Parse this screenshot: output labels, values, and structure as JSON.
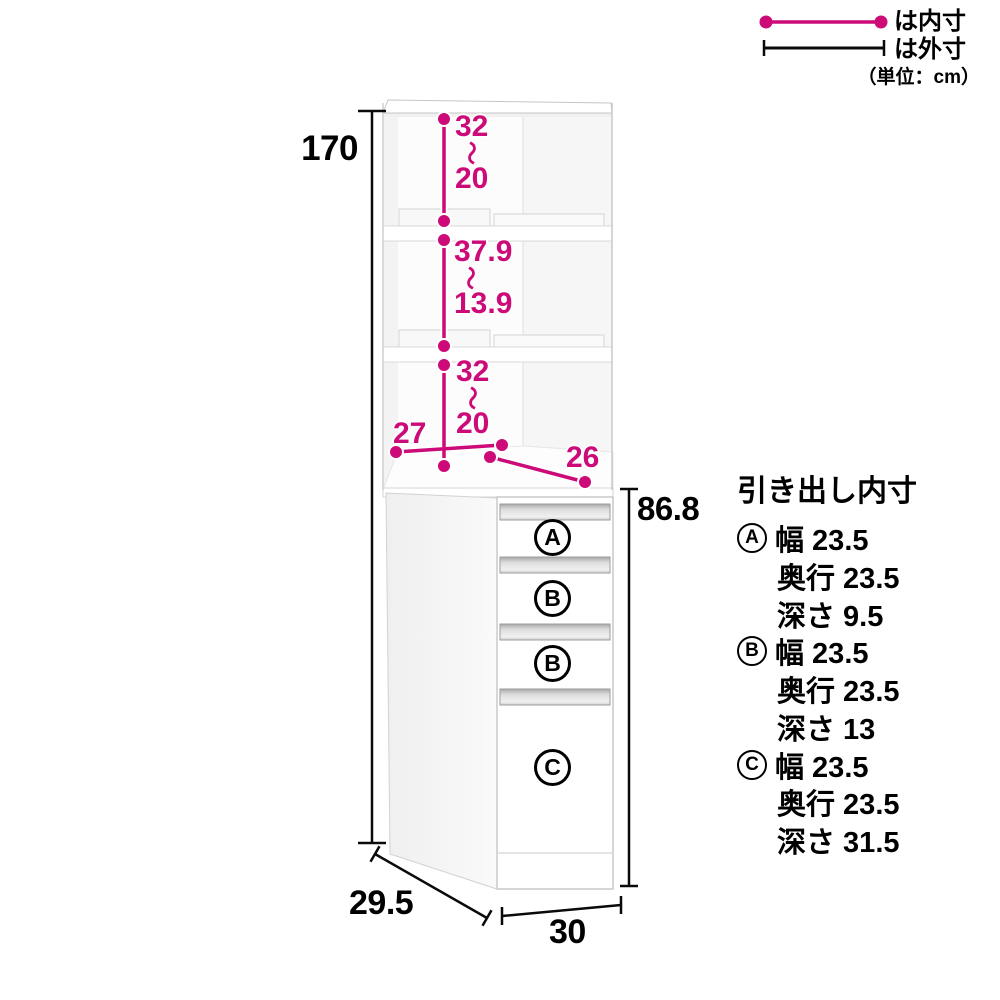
{
  "legend": {
    "inner_label": "は内寸",
    "outer_label": "は外寸",
    "unit_note": "（単位：cm）"
  },
  "dimensions": {
    "total_height": "170",
    "lower_unit_height": "86.8",
    "depth": "29.5",
    "width": "30",
    "open_section_depth": "27",
    "open_section_width": "26",
    "shelf_sections": [
      {
        "max": "32",
        "tilde": "〜",
        "min": "20"
      },
      {
        "max": "37.9",
        "tilde": "〜",
        "min": "13.9"
      },
      {
        "max": "32",
        "tilde": "〜",
        "min": "20"
      }
    ]
  },
  "drawers": {
    "labels": [
      "A",
      "B",
      "B",
      "C"
    ]
  },
  "specs": {
    "title": "引き出し内寸",
    "items": [
      {
        "label": "A",
        "rows": [
          "幅 23.5",
          "奥行 23.5",
          "深さ 9.5"
        ]
      },
      {
        "label": "B",
        "rows": [
          "幅 23.5",
          "奥行 23.5",
          "深さ 13"
        ]
      },
      {
        "label": "C",
        "rows": [
          "幅 23.5",
          "奥行 23.5",
          "深さ 31.5"
        ]
      }
    ]
  },
  "colors": {
    "accent": "#cc0a78",
    "ink": "#000000"
  }
}
